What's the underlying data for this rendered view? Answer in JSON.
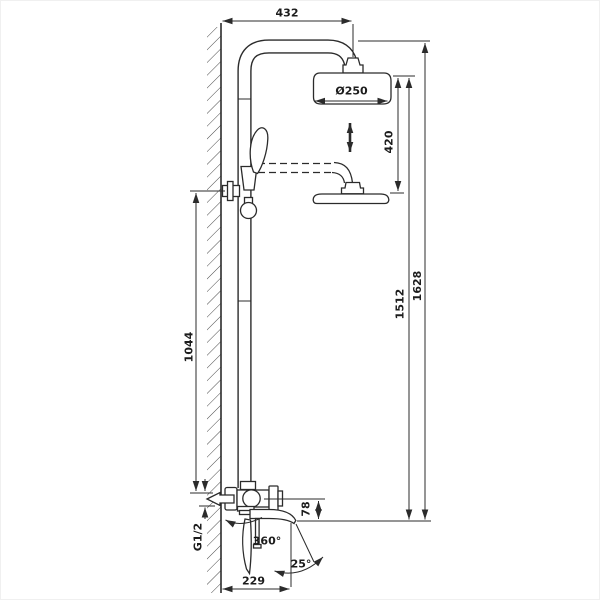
{
  "drawing": {
    "subject": "Wall-mounted shower column with overhead rain shower, hand shower and swivel bath spout — dimensioned technical drawing",
    "ink_color": "#2b2b2b",
    "background": "#ffffff",
    "labels": {
      "top_offset": "432",
      "head_diameter": "Ø250",
      "height_adjust": "420",
      "column_height": "1512",
      "total_height": "1628",
      "bar_height": "1044",
      "spout_drop": "78",
      "inlet_thread": "G1/2",
      "spout_swivel": "360°",
      "spray_angle": "25°",
      "spout_reach": "229"
    }
  }
}
